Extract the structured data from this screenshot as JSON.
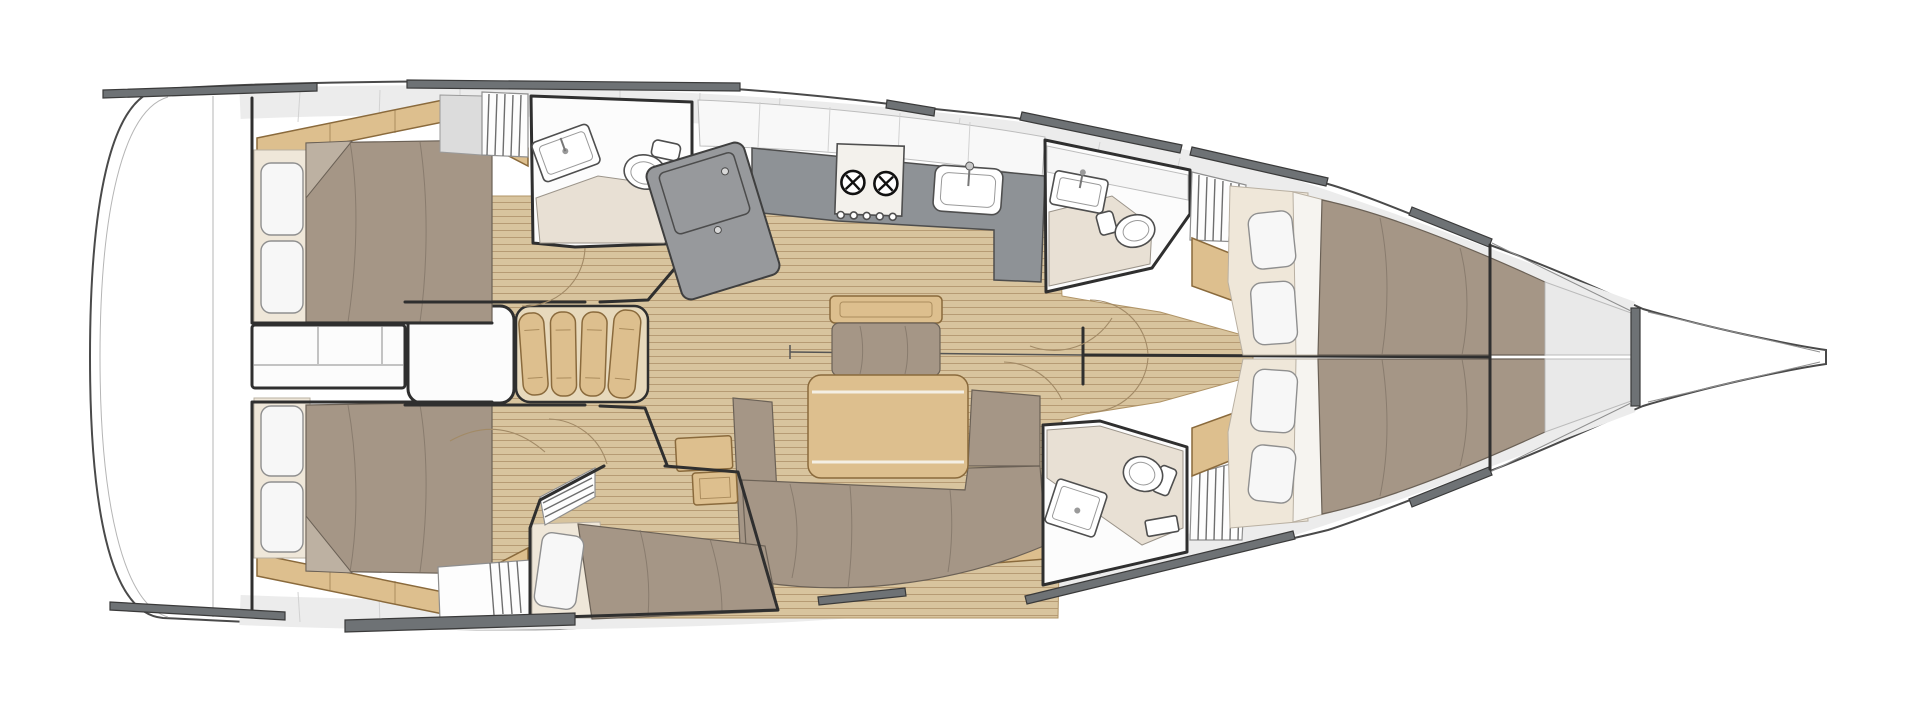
{
  "diagram_type": "sailboat-interior-floor-plan",
  "orientation": "bow-right",
  "colors": {
    "hull_outline": "#4a4a4a",
    "hull_inner": "#b5b5b5",
    "deck_hardware": "#6e7275",
    "panel_light": "#ececec",
    "panel_seam": "#d2d2d2",
    "room_white": "#fcfcfc",
    "wall": "#2f2f2f",
    "teak_floor": "#d8c49e",
    "teak_stripe": "#ab8e65",
    "oak": "#ddbf8e",
    "oak_dark": "#8a6a3c",
    "upholstery": "#a59686",
    "upholstery_line": "#7d7164",
    "pillow": "#f7f7f7",
    "mattress": "#efe7d9",
    "head_floor": "#e8e0d4",
    "counter": "#8e9296",
    "chart_table": "#97999c",
    "fixture": "#4f4f4f",
    "door_arc": "#a28a66",
    "door_leaf": "#666666"
  },
  "features": {
    "hull": "sailboat-hull",
    "bow": "bow-and-bowsprit",
    "deck_hardware": "deck-hatch-strips",
    "stern_storage": "stern-storage-shelves",
    "engine_box": "engine-compartment",
    "companionway": "companionway-steps",
    "aft_port_cabin": "aft-cabin-port-double-berth",
    "aft_stbd_cabin": "aft-cabin-starboard-double-berth",
    "third_cabin": "single-berth-cabin",
    "aft_head": "aft-head-with-shower",
    "fwd_head_port": "forward-head-port",
    "fwd_head_stbd": "forward-head-starboard",
    "galley": "galley",
    "chart_table": "chart-table",
    "stove": "two-burner-stove",
    "galley_sink": "galley-sink",
    "salon": "salon",
    "salon_table": "salon-table",
    "salon_sofa": "salon-settee",
    "salon_bench": "salon-bench-seat",
    "stool": "salon-stool",
    "lockers": "hanging-lockers",
    "fwd_cabin_port": "forward-cabin-port-berth",
    "fwd_cabin_stbd": "forward-cabin-starboard-berth",
    "forepeak": "forepeak-anchor-locker",
    "doors": "door-swing-arcs",
    "teak": "teak-cabin-sole"
  }
}
